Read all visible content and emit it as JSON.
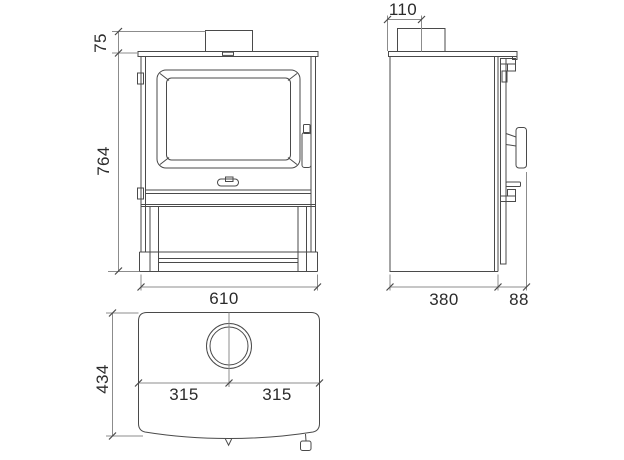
{
  "colors": {
    "object_line": "#4a4a4a",
    "dimension_line": "#8c8c8c",
    "text": "#2b2b2b",
    "background": "#ffffff"
  },
  "views": {
    "front": {
      "label": "front-view",
      "dims": {
        "flue_collar_height": "75",
        "body_height": "764",
        "width": "610"
      }
    },
    "side": {
      "label": "side-view",
      "dims": {
        "flue_center_from_rear": "110",
        "body_depth": "380",
        "door_handle_depth": "88"
      }
    },
    "top": {
      "label": "top-view",
      "dims": {
        "overall_depth": "434",
        "flue_center_left": "315",
        "flue_center_right": "315"
      }
    }
  }
}
